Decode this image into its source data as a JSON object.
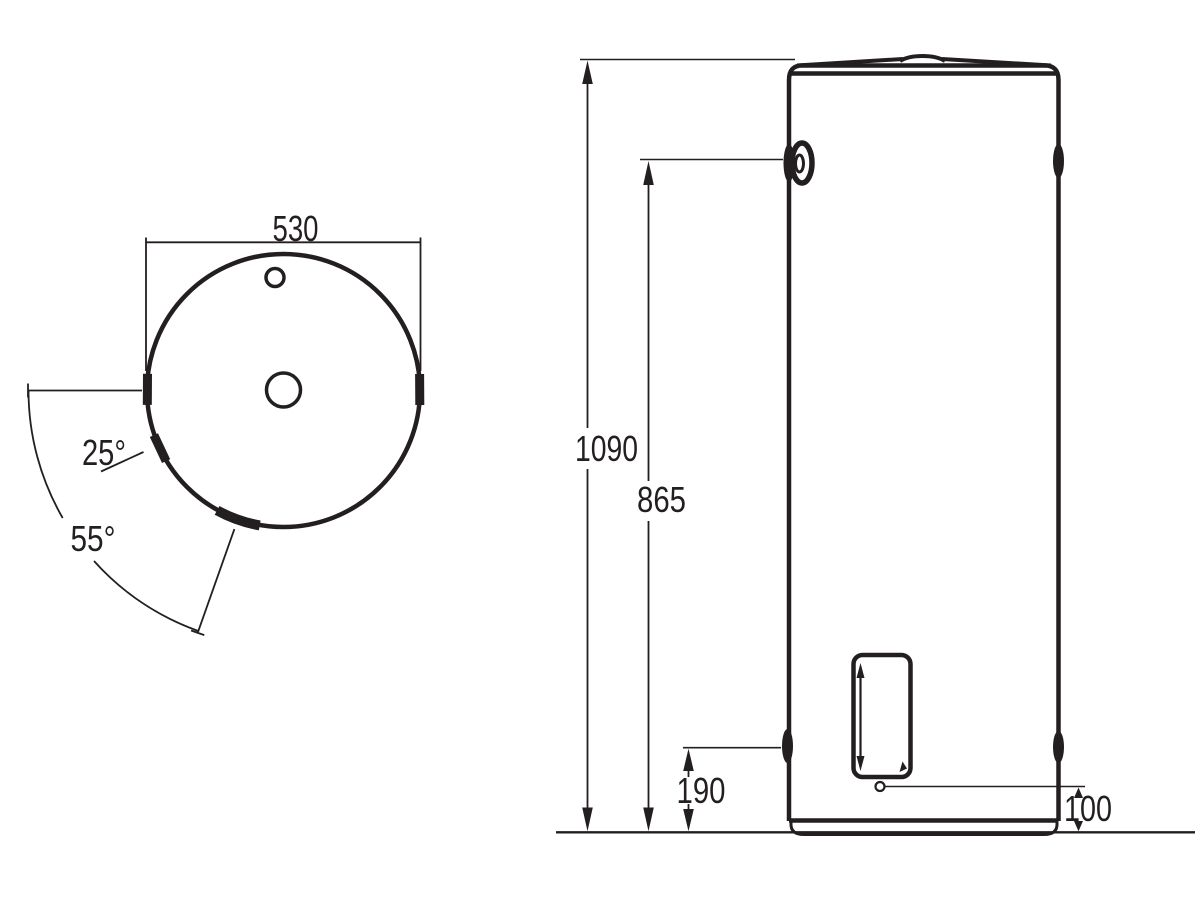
{
  "page": {
    "background_color": "#ffffff",
    "line_color": "#231f20",
    "description": "Water heater technical dimension drawing, top view and front view"
  },
  "top_view": {
    "diameter_label": "530",
    "angle_25_label": "25°",
    "angle_55_label": "55°"
  },
  "front_view": {
    "overall_height_label": "1090",
    "side_connection_height_label": "865",
    "lower_connection_height_label": "190",
    "drain_height_label": "100"
  }
}
